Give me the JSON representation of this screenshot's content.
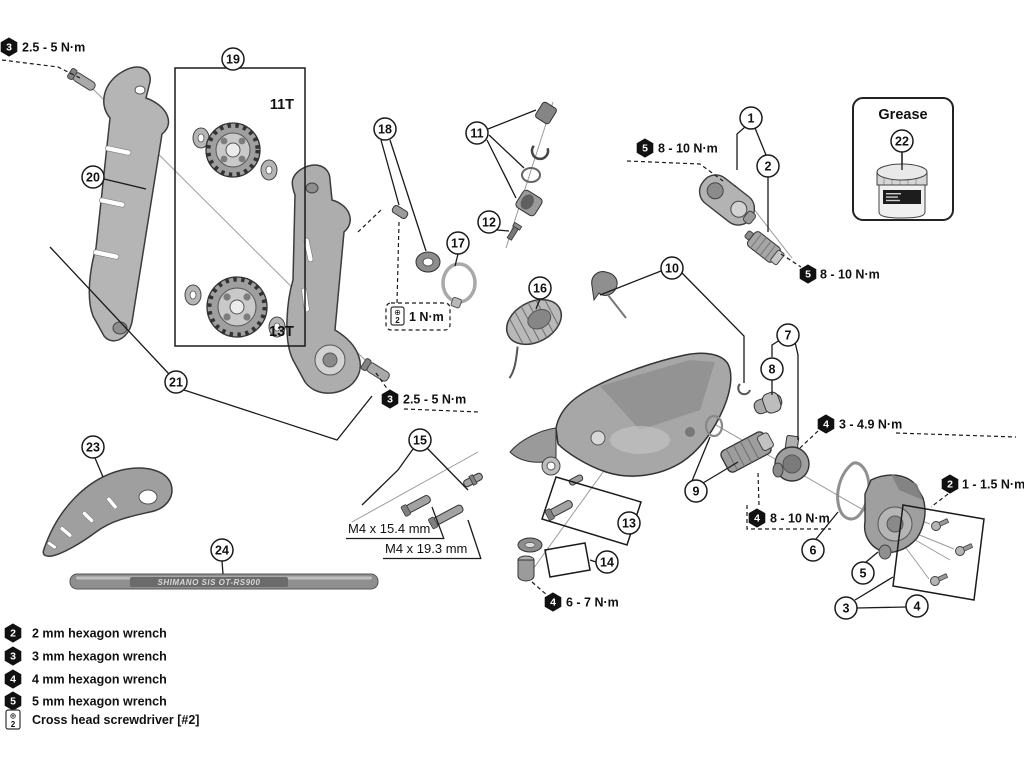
{
  "callouts": {
    "c1": "1",
    "c2": "2",
    "c3": "3",
    "c4": "4",
    "c5": "5",
    "c6": "6",
    "c7": "7",
    "c8": "8",
    "c9": "9",
    "c10": "10",
    "c11": "11",
    "c12": "12",
    "c13": "13",
    "c14": "14",
    "c15": "15",
    "c16": "16",
    "c17": "17",
    "c18": "18",
    "c19": "19",
    "c20": "20",
    "c21": "21",
    "c22": "22",
    "c23": "23",
    "c24": "24"
  },
  "labels": {
    "pulley_upper_teeth": "11T",
    "pulley_lower_teeth": "13T",
    "grease": "Grease",
    "bolt_length_short": "M4 x 15.4 mm",
    "bolt_length_long": "M4 x 19.3 mm",
    "cable_marking": "SHIMANO SIS OT-RS900"
  },
  "torque": {
    "cage_bolt_upper": {
      "tool_size": "3",
      "value": "2.5 - 5 N·m"
    },
    "cage_bolt_lower": {
      "tool_size": "3",
      "value": "2.5 - 5 N·m"
    },
    "b_link_upper": {
      "tool_size": "5",
      "value": "8 - 10 N·m"
    },
    "b_link_lower": {
      "tool_size": "5",
      "value": "8 - 10 N·m"
    },
    "stopper_screw": {
      "tool": "cross-head-screwdriver",
      "value": "1 N·m"
    },
    "bracket_axle": {
      "tool_size": "4",
      "value": "3 - 4.9 N·m"
    },
    "clutch_unit": {
      "tool_size": "4",
      "value": "8 - 10 N·m"
    },
    "cover_screws": {
      "tool_size": "2",
      "value": "1 - 1.5 N·m"
    },
    "cage_stud_nut": {
      "tool_size": "4",
      "value": "6 - 7 N·m"
    }
  },
  "icons": {
    "cross_head": {
      "symbol": "⊕",
      "bit": "2"
    }
  },
  "legend": {
    "items": [
      {
        "icon": "hex-wrench",
        "size": "2",
        "label": "2 mm hexagon wrench"
      },
      {
        "icon": "hex-wrench",
        "size": "3",
        "label": "3 mm hexagon wrench"
      },
      {
        "icon": "hex-wrench",
        "size": "4",
        "label": "4 mm hexagon wrench"
      },
      {
        "icon": "hex-wrench",
        "size": "5",
        "label": "5 mm hexagon wrench"
      },
      {
        "icon": "cross-head-screwdriver",
        "label": "Cross head screwdriver [#2]"
      }
    ]
  },
  "colors": {
    "line": "#1a1a1a",
    "part_light": "#c6c6c6",
    "part_mid": "#a7a7a7",
    "part_dark": "#7c7c7c",
    "badge": "#111111",
    "background": "#ffffff"
  }
}
